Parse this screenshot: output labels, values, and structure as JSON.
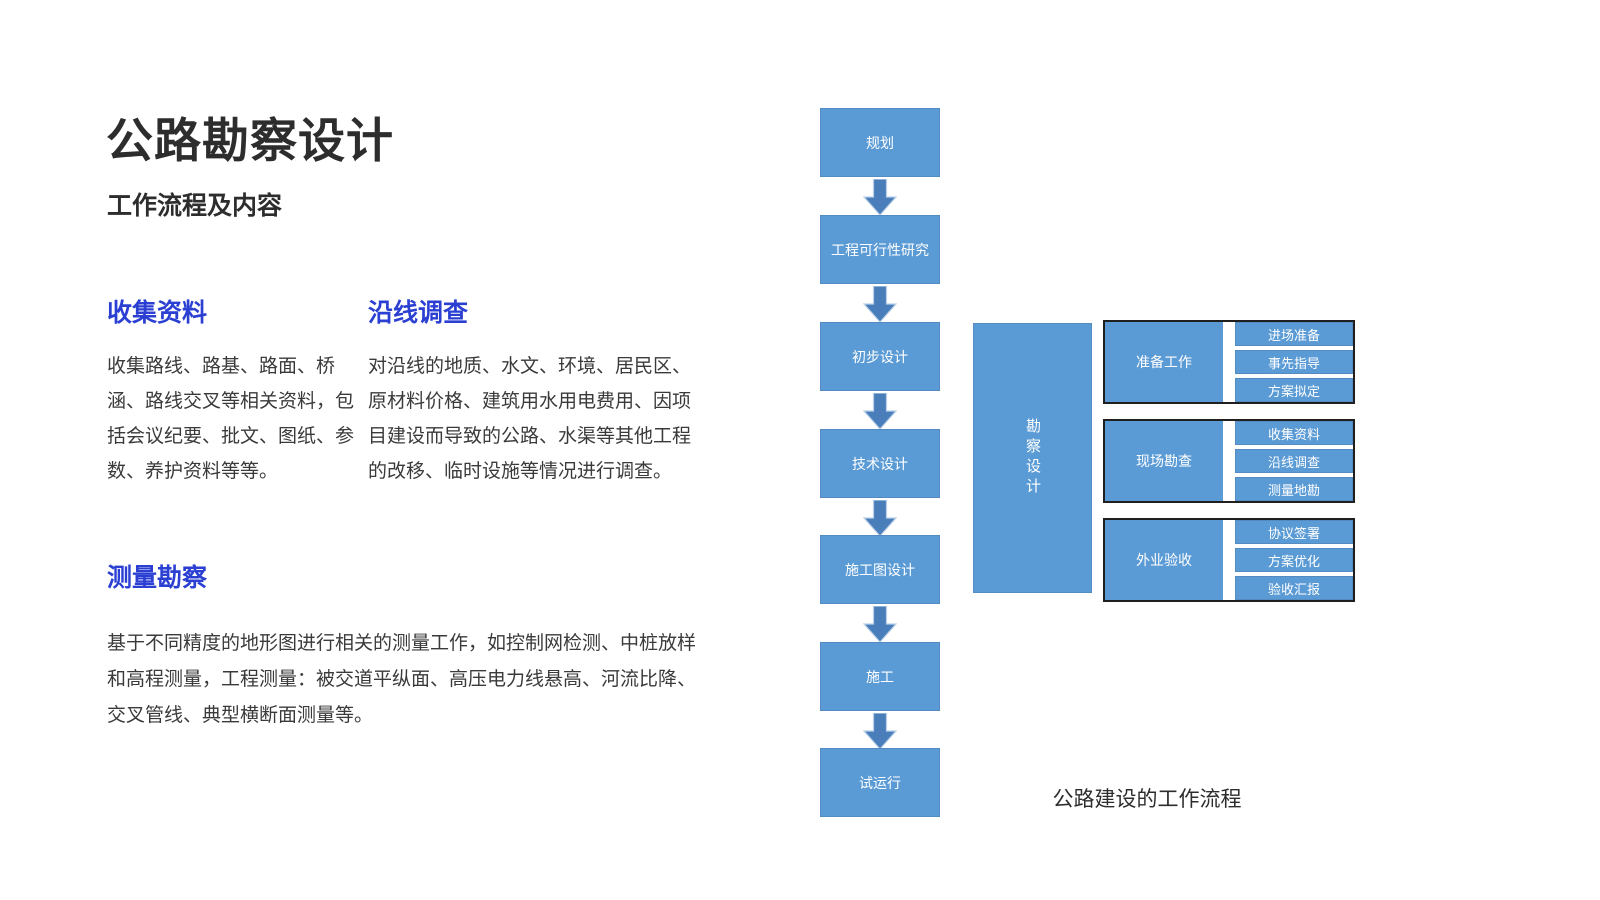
{
  "slide": {
    "title": "公路勘察设计",
    "subtitle": "工作流程及内容",
    "sections": [
      {
        "heading": "收集资料",
        "body": "收集路线、路基、路面、桥涵、路线交叉等相关资料，包括会议纪要、批文、图纸、参数、养护资料等等。"
      },
      {
        "heading": "沿线调查",
        "body": "对沿线的地质、水文、环境、居民区、原材料价格、建筑用水用电费用、因项目建设而导致的公路、水渠等其他工程的改移、临时设施等情况进行调查。"
      },
      {
        "heading": "测量勘察",
        "body": "基于不同精度的地形图进行相关的测量工作，如控制网检测、中桩放样和高程测量，工程测量：被交道平纵面、高压电力线悬高、河流比降、交叉管线、典型横断面测量等。"
      }
    ]
  },
  "flowchart": {
    "steps": [
      "规划",
      "工程可行性研究",
      "初步设计",
      "技术设计",
      "施工图设计",
      "施工",
      "试运行"
    ],
    "side_label": "勘察设计",
    "groups": [
      {
        "label": "准备工作",
        "items": [
          "进场准备",
          "事先指导",
          "方案拟定"
        ]
      },
      {
        "label": "现场勘查",
        "items": [
          "收集资料",
          "沿线调查",
          "测量地勘"
        ]
      },
      {
        "label": "外业验收",
        "items": [
          "协议签署",
          "方案优化",
          "验收汇报"
        ]
      }
    ],
    "caption": "公路建设的工作流程"
  },
  "colors": {
    "page-bg": "#ffffff",
    "box-blue": "#5b9bd5",
    "arrow-blue": "#4a7ebb",
    "arrow-edge": "#b9d0e8",
    "heading-blue": "#2b40d3",
    "text-dark": "#2d2d2d",
    "body-text": "#3a3a3a",
    "group-border": "#1f1f1f"
  }
}
